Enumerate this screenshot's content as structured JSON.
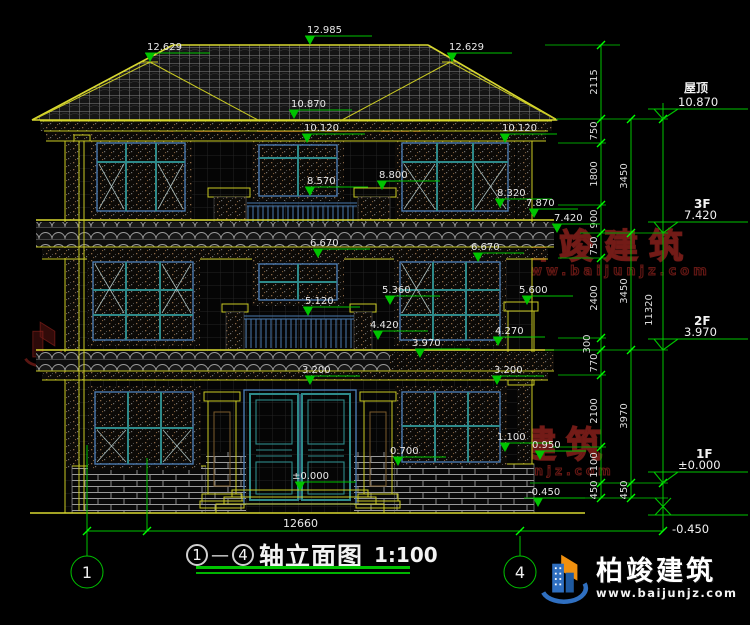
{
  "watermark": {
    "name": "柏竣建筑",
    "site": "www.baijunjz.com"
  },
  "brand": {
    "name": "柏竣建筑",
    "site": "www.baijunjz.com"
  },
  "footer": {
    "total_width": "12660",
    "axis_left": "1",
    "axis_right": "4",
    "title_dash": "—",
    "title_text": "轴立面图",
    "title_scale": "1:100"
  },
  "levels": [
    {
      "label": "屋顶",
      "value": "10.870"
    },
    {
      "label": "3F",
      "value": "7.420"
    },
    {
      "label": "2F",
      "value": "3.970"
    },
    {
      "label": "1F",
      "value": "±0.000"
    },
    {
      "label": "",
      "value": "-0.450"
    }
  ],
  "dims": {
    "col1": [
      "2115",
      "750",
      "1800",
      "900",
      "750",
      "2400",
      "300",
      "770",
      "2100",
      "1100",
      "450"
    ],
    "col2": [
      "3450",
      "3450",
      "3970",
      "450"
    ],
    "col3": [
      "11320"
    ]
  },
  "elev": {
    "k12629": "12.629",
    "k12985": "12.985",
    "k10870": "10.870",
    "k10120": "10.120",
    "k8800": "8.800",
    "k8570": "8.570",
    "k8320": "8.320",
    "k7870": "7.870",
    "k7420": "7.420",
    "k6670": "6.670",
    "k5600": "5.600",
    "k5360": "5.360",
    "k5120": "5.120",
    "k4420": "4.420",
    "k4270": "4.270",
    "k3970": "3.970",
    "k3200": "3.200",
    "k1100": "1.100",
    "k0950": "0.950",
    "k0700": "0.700",
    "k0000": "±0.000",
    "kneg0450": "-0.450"
  }
}
